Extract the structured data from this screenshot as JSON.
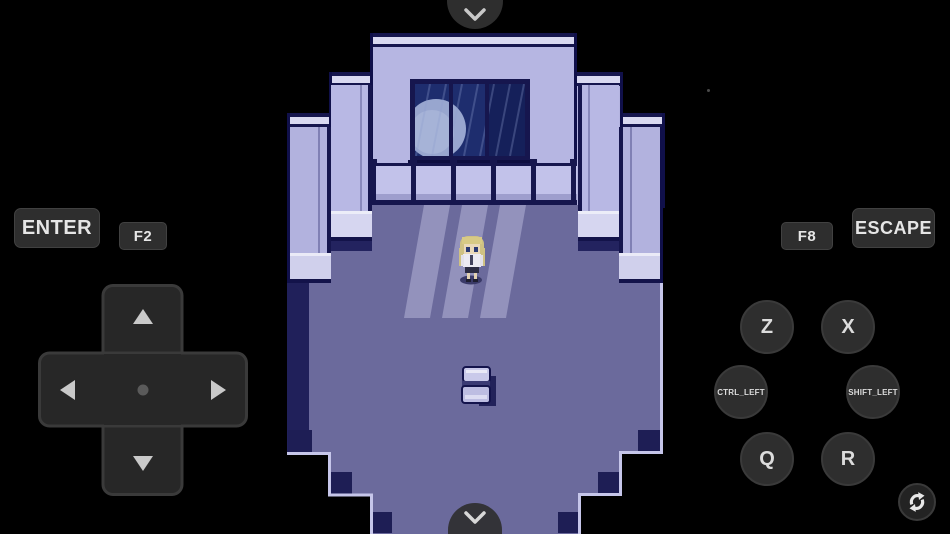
{
  "app": {
    "name": "rpg-touch-emulator",
    "scene": "moonlit bedroom with character"
  },
  "colors": {
    "background": "#000000",
    "button_bg": "#2e2e2e",
    "button_text": "#e6e6e6",
    "wall": "#b4b4e0",
    "wall_highlight": "#dcdcf2",
    "outline": "#16164e",
    "floor": "#6b6a9c",
    "floor_shadow": "#20205a",
    "moonbeam": "#9a99c2",
    "window_night": "#1e2d6e"
  },
  "controls": {
    "top_toggle": {
      "icon": "chevron-down"
    },
    "bottom_toggle": {
      "icon": "chevron-down"
    },
    "keys": {
      "enter": "ENTER",
      "f2": "F2",
      "f8": "F8",
      "escape": "ESCAPE"
    },
    "action_buttons": [
      {
        "label": "Z"
      },
      {
        "label": "X"
      },
      {
        "label": "CTRL_LEFT"
      },
      {
        "label": "SHIFT_LEFT"
      },
      {
        "label": "Q"
      },
      {
        "label": "R"
      }
    ],
    "dpad": {
      "directions": [
        "up",
        "left",
        "right",
        "down"
      ]
    },
    "rotate_button": {
      "icon": "rotate-screen"
    }
  },
  "game": {
    "elements": [
      "stepped wall",
      "window with moon",
      "railing",
      "moonlight beams",
      "player character",
      "chair"
    ]
  }
}
